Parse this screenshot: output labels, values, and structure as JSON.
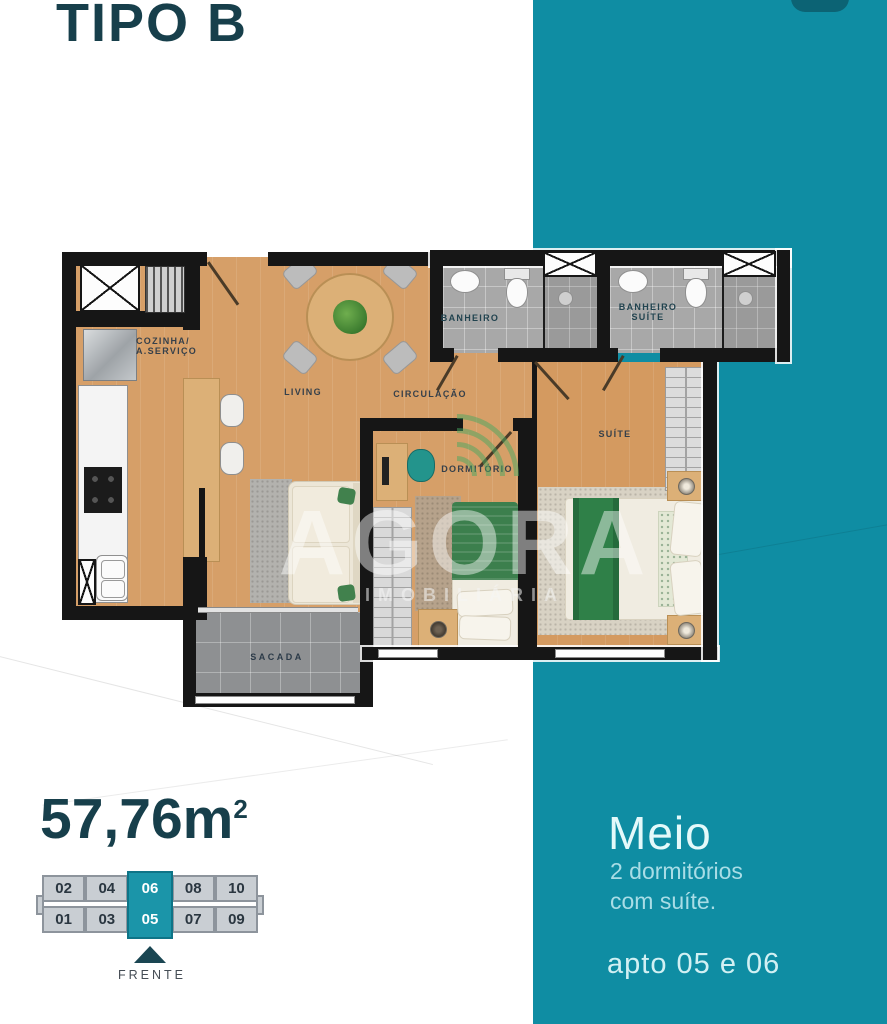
{
  "title": "TIPO B",
  "colors": {
    "band": "#0f8da3",
    "band_dark_tab": "#0c6374",
    "heading_dark": "#173f4b",
    "unit_highlight": "#1b95a9"
  },
  "area": {
    "value": "57,76m",
    "sup": "2"
  },
  "side_panel": {
    "heading": "Meio",
    "line1": "2 dormitórios",
    "line2": "com suíte.",
    "footer": "apto 05 e 06"
  },
  "plan": {
    "labels": {
      "kitchen_l1": "COZINHA/",
      "kitchen_l2": "A.SERVIÇO",
      "living": "LIVING",
      "circulation": "CIRCULAÇÃO",
      "bathroom": "BANHEIRO",
      "bathroom_suite_l1": "BANHEIRO",
      "bathroom_suite_l2": "SUÍTE",
      "suite": "SUÍTE",
      "bedroom": "DORMITÓRIO",
      "balcony": "SACADA"
    },
    "watermark": {
      "brand": "AGORA",
      "sub": "IMOBILIÁRIA"
    }
  },
  "building_key": {
    "top_row": [
      "02",
      "04",
      "06",
      "08",
      "10"
    ],
    "bottom_row": [
      "01",
      "03",
      "05",
      "07",
      "09"
    ],
    "front_label": "FRENTE"
  }
}
